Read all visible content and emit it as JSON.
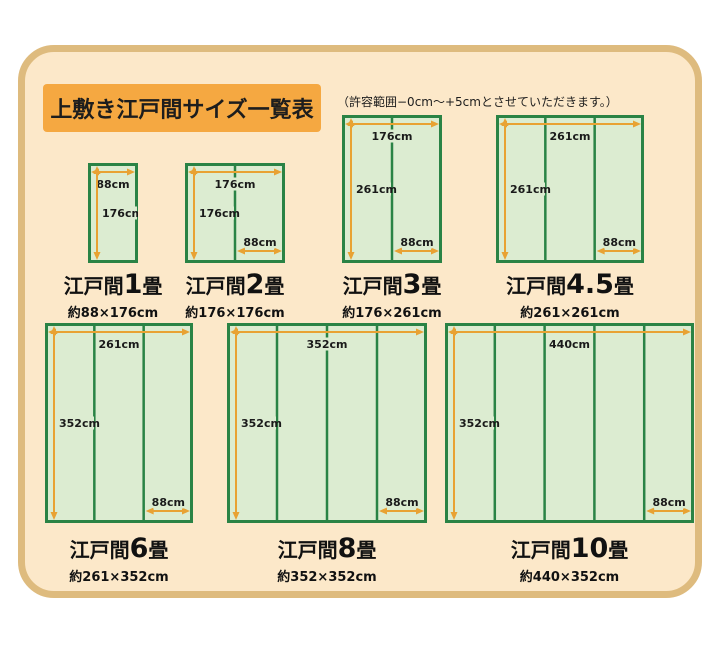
{
  "header": {
    "title": "上敷き江戸間サイズ一覧表",
    "note": "（許容範囲−0cm～+5cmとさせていただきます。）"
  },
  "colors": {
    "panel_bg": "#fce8c9",
    "panel_border": "#debb7e",
    "title_bg": "#f5a841",
    "mat_border": "#2a8345",
    "mat_fill": "#dcecd1",
    "arrow": "#e8a233",
    "label_text": "#1a1a1a"
  },
  "unit": "cm",
  "diagrams": [
    {
      "id": "edoma-1",
      "caption_prefix": "江戸間",
      "caption_num": "1",
      "caption_suffix": "畳",
      "dims_label": "約88×176cm",
      "width_cm": 88,
      "height_cm": 176,
      "strips": 1,
      "width_label": "88cm",
      "height_label": "176cm",
      "strip_label": ""
    },
    {
      "id": "edoma-2",
      "caption_prefix": "江戸間",
      "caption_num": "2",
      "caption_suffix": "畳",
      "dims_label": "約176×176cm",
      "width_cm": 176,
      "height_cm": 176,
      "strips": 2,
      "width_label": "176cm",
      "height_label": "176cm",
      "strip_label": "88cm"
    },
    {
      "id": "edoma-3",
      "caption_prefix": "江戸間",
      "caption_num": "3",
      "caption_suffix": "畳",
      "dims_label": "約176×261cm",
      "width_cm": 176,
      "height_cm": 261,
      "strips": 2,
      "width_label": "176cm",
      "height_label": "261cm",
      "strip_label": "88cm"
    },
    {
      "id": "edoma-4_5",
      "caption_prefix": "江戸間",
      "caption_num": "4.5",
      "caption_suffix": "畳",
      "dims_label": "約261×261cm",
      "width_cm": 261,
      "height_cm": 261,
      "strips": 3,
      "width_label": "261cm",
      "height_label": "261cm",
      "strip_label": "88cm"
    },
    {
      "id": "edoma-6",
      "caption_prefix": "江戸間",
      "caption_num": "6",
      "caption_suffix": "畳",
      "dims_label": "約261×352cm",
      "width_cm": 261,
      "height_cm": 352,
      "strips": 3,
      "width_label": "261cm",
      "height_label": "352cm",
      "strip_label": "88cm"
    },
    {
      "id": "edoma-8",
      "caption_prefix": "江戸間",
      "caption_num": "8",
      "caption_suffix": "畳",
      "dims_label": "約352×352cm",
      "width_cm": 352,
      "height_cm": 352,
      "strips": 4,
      "width_label": "352cm",
      "height_label": "352cm",
      "strip_label": "88cm"
    },
    {
      "id": "edoma-10",
      "caption_prefix": "江戸間",
      "caption_num": "10",
      "caption_suffix": "畳",
      "dims_label": "約440×352cm",
      "width_cm": 440,
      "height_cm": 352,
      "strips": 5,
      "width_label": "440cm",
      "height_label": "352cm",
      "strip_label": "88cm"
    }
  ]
}
